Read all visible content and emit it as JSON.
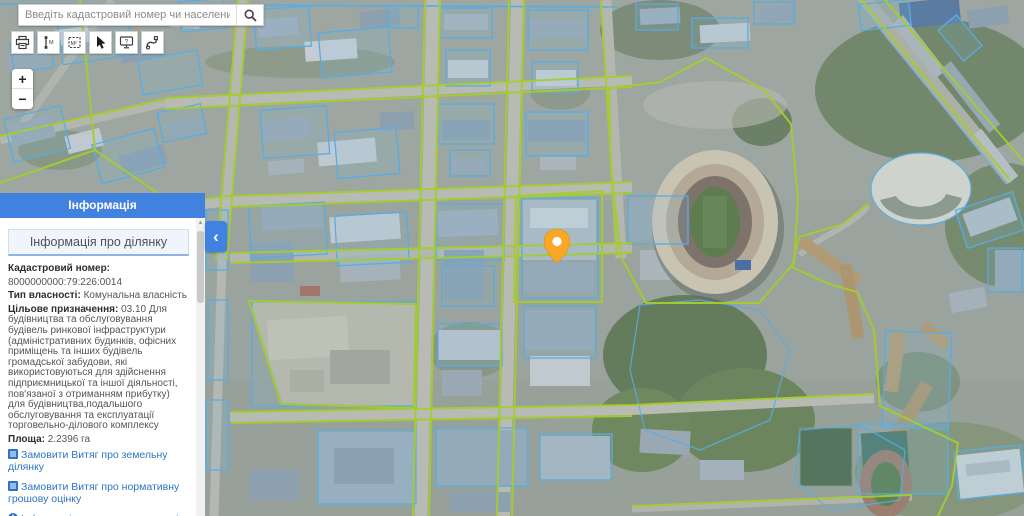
{
  "search": {
    "placeholder": "Введіть кадастровий номер чи населений пунк",
    "icon": "search-icon"
  },
  "toolbar": {
    "buttons": [
      {
        "name": "print",
        "icon": "printer-icon"
      },
      {
        "name": "measure-distance",
        "icon": "ruler-icon"
      },
      {
        "name": "measure-area",
        "icon": "area-m2-icon"
      },
      {
        "name": "select-cursor",
        "icon": "cursor-icon"
      },
      {
        "name": "help",
        "icon": "monitor-question-icon"
      },
      {
        "name": "route",
        "icon": "route-icon"
      }
    ]
  },
  "zoom_control": {
    "zoom_in": "+",
    "zoom_out": "−"
  },
  "panel": {
    "header": "Інформація",
    "section_title": "Інформація про ділянку",
    "fields": {
      "cadastral_label": "Кадастровий номер:",
      "cadastral_value": "8000000000:79:226:0014",
      "ownership_label": "Тип власності:",
      "ownership_value": "Комунальна власність",
      "purpose_label": "Цільове призначення:",
      "purpose_value": "03.10 Для будівництва та обслуговування будівель ринкової інфраструктури (адміністративних будинків, офісних приміщень та інших будівель громадської забудови, які використовуються для здійснення підприємницької та іншої діяльності, пов'язаної з отриманням прибутку) для будівництва,подальшого обслуговування та експлуатації торговельно-ділового комплексу",
      "area_label": "Площа:",
      "area_value": "2.2396 га"
    },
    "links": [
      {
        "icon": "document-icon",
        "text": "Замовити Витяг про земельну ділянку"
      },
      {
        "icon": "document-icon",
        "text": "Замовити Витяг про нормативну грошову оцінку"
      },
      {
        "icon": "info-icon",
        "text": "Інформація про право власності та речові права"
      }
    ],
    "collapse_icon": "‹"
  },
  "map": {
    "marker": "map-marker",
    "overlay_colors": {
      "cadastral_quarter_line": "#A4CD2E",
      "parcel_line": "#58ACE4",
      "marker_orange": "#F9A825",
      "ui_accent_blue": "#4181E0",
      "link_blue": "#2D74C4"
    }
  }
}
